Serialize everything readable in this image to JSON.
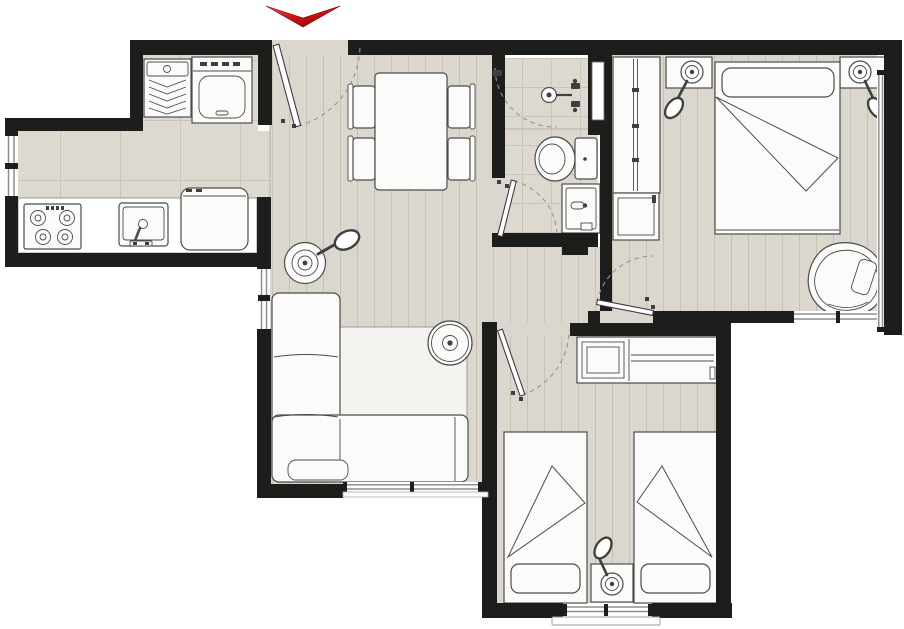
{
  "title": "apartment floor plan",
  "entrance": {
    "label": "entrance",
    "marker": "red-arrow-down-icon"
  },
  "colors": {
    "wall": "#1d1d1b",
    "plank": "#dcd7ce",
    "plankLine": "#c8c2b6",
    "tile": "#ded9d0",
    "tileLine": "#cbc5b9",
    "fixture": "#fbfbfa",
    "stroke": "#4c4c4c",
    "rug": "#f4f3f0",
    "windowLine": "#8f8f8f",
    "dash": "#949494",
    "arrowLight": "#f4564b",
    "arrowMid": "#d41414",
    "arrowDark": "#8c0909"
  },
  "rooms": {
    "laundry": {
      "label": "laundry area",
      "items": [
        "laundry-sink",
        "washing-machine"
      ]
    },
    "kitchen": {
      "label": "kitchen",
      "items": [
        "cooktop-4-burner",
        "kitchen-sink",
        "refrigerator",
        "counter"
      ]
    },
    "dining": {
      "label": "dining area",
      "items": [
        "dining-table",
        "chair",
        "chair",
        "chair",
        "chair"
      ]
    },
    "living": {
      "label": "living room",
      "items": [
        "corner-sofa",
        "rug",
        "side-table",
        "floor-lamp"
      ]
    },
    "bathroom": {
      "label": "bathroom",
      "items": [
        "shower-head",
        "toilet",
        "washbasin-cabinet"
      ]
    },
    "master_bedroom": {
      "label": "double bedroom",
      "items": [
        "double-bed",
        "wardrobe",
        "dresser",
        "nightstand",
        "nightstand",
        "table-lamp",
        "table-lamp",
        "armchair"
      ]
    },
    "twin_bedroom": {
      "label": "twin bedroom",
      "items": [
        "single-bed",
        "single-bed",
        "wardrobe",
        "nightstand",
        "table-lamp"
      ]
    }
  },
  "counts": {
    "doors": 5,
    "windows": 7
  }
}
